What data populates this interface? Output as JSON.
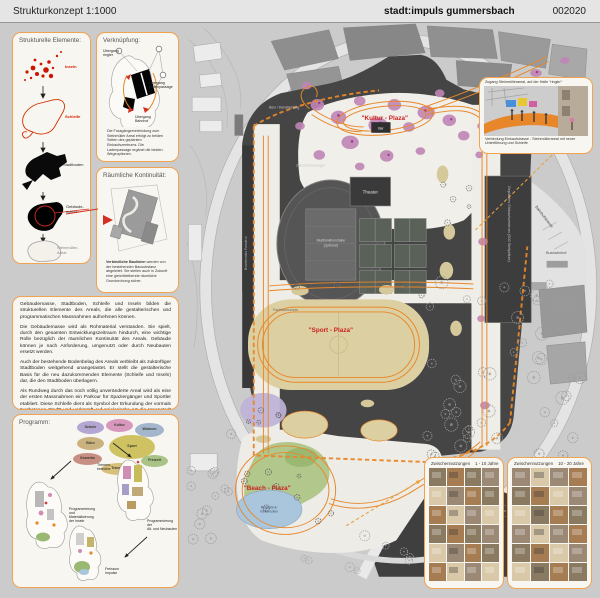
{
  "header": {
    "title": "Strukturkonzept 1:1000",
    "project": "stadt:impuls gummersbach",
    "code": "002020"
  },
  "colors": {
    "accent_orange": "#e8872a",
    "panel_border": "#f0a351",
    "label_red": "#cc2020",
    "site_dark": "#454545",
    "insel_pink": "#c085b5",
    "sport_beige": "#dcd0a2",
    "beach_green": "#b2c78c",
    "pond_blue": "#a9c6dd"
  },
  "panels": {
    "elements": {
      "title": "Strukturelle Elemente:",
      "items": [
        {
          "label": "Inseln"
        },
        {
          "label": "Schleife"
        },
        {
          "label": "Stadtboden"
        },
        {
          "label": "Gebäude-\nmasse"
        },
        {
          "label": "Steinmüller-\nAreal"
        }
      ]
    },
    "linkage": {
      "title": "Verknüpfung:",
      "labels": [
        "Übergang\nringler",
        "Übergang\nLadenpassage",
        "Übergang\nBahnhof"
      ],
      "text": "Die Fussgängerverbindung zum Steinmüller Areal erfolgt zu beiden Seiten des geplanten Einkaufszentrums. Die Ladenpassage ergänzt die beiden Wegeoptionen."
    },
    "continuity": {
      "title": "Räumliche Kontinuität:",
      "lead": "Verbindliche Baulinien",
      "text": " werden von der bestehenden Bausubstanz abgeleitet. Sie stellen auch in Zukunft eine gleichbleibende räumliche Grundordnung sicher."
    },
    "maintext": {
      "paragraphs": [
        "Gebäudemasse, Stadtboden, Schleife und Inseln bilden die strukturellen Elemente des Areals, die alle gestalterischen und programmatischen Massnahmen aufnehmen können.",
        "Die Gebäudemasse wird als Rohmaterial verstanden. Sie spielt, durch den gesamten Entwicklungszeitraum hindurch, eine wichtige Rolle bezüglich der räumlichen Kontinuität des Areals. Gebäude können je nach Anforderung, umgenutzt oder durch Neubauten ersetzt werden.",
        "Auch der bestehende Bodenbelag des Areals verbleibt als zukünftiger Stadtboden weitgehend unangetastet. Er stellt die gestalterische Basis für die neu dazukommenden Elemente (Schleife und Inseln) dar, die den Stadtboden überlagern.",
        "Als Rundweg durch das noch völlig unveränderte Areal wird als eine der ersten Massnahmen ein Parkour für Spaziergänger und Sportler etabliert. Diese Schleife dient als Symbol der Erkundung der vormals \"verbotenen Stadt\" und verknüpft auf spielerische Art die Innenstadt mit den verschiedenen Bereichen des Steinmüller Geländes.",
        "Alle gestalterischen Massnahmen konzentrieren sich auf abgegrenzte Felder, die den Stadtboden überlagern. Es sind \"chirurgische Eingriffe\" auf Inseln, die per Definition in ihrer Ausdehnung begrenzt sind. Eine flächendeckende Aufwertung wird dadurch auch beim Einsatz von geringen ökonomischen Mitteln ermöglicht werden."
      ]
    },
    "programm": {
      "title": "Programm:",
      "bubble_words": [
        "Schule",
        "Kultur",
        "Wohnen",
        "Sport",
        "Büro",
        "Gewerbe",
        "Transport",
        "Freizeit"
      ],
      "labels": [
        "Themen-\nbereiche",
        "Programmierung\nund\nMaterialisierung\nder Inseln",
        "Programmierung\nder\nAlt- und Neubauten",
        "Freiraum\nImpulse"
      ]
    }
  },
  "map": {
    "labels": {
      "kultur": "\"Kultur - Plaza\"",
      "sport": "\"Sport - Plaza\"",
      "beach": "\"Beach - Plaza\"",
      "bar": "Bar",
      "theater": "Theater",
      "pond1": "Regenrück-",
      "pond2": "haltebecken",
      "hall1": "Multifunktionshalle",
      "hall2": "(optional)",
      "mall": "Geplantes Einkaufszentrum (500 Stellplätze)",
      "office": "Büro / Dienstleistung",
      "interim": "Zwischennutzungen",
      "fh": "Fachhochschule",
      "bus": "Busbahnhof",
      "street": "Bahnhofstrasse",
      "parkdeck": "Bestehendes Parkdeck"
    }
  },
  "insets": {
    "photo": {
      "caption_top": "Zugang Steinmüllerareal, auf der Halle \"ringler\"",
      "caption_bottom": "Verbindung Einkaufstrasse - Steinmüllerareal mit neuer Unterführung und Schleife"
    },
    "grids": [
      {
        "title": "Zwischennutzungen",
        "range": "1 - 10 Jahre"
      },
      {
        "title": "Zwischennutzungen",
        "range": "10 - 20 Jahre"
      }
    ]
  }
}
